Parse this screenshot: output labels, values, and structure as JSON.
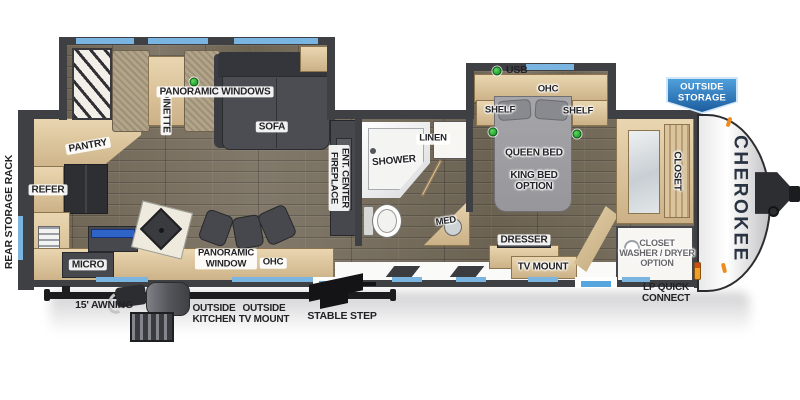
{
  "brand": {
    "name": "CHEROKEE"
  },
  "legend": {
    "usb": "USB"
  },
  "badges": {
    "outside_storage": "OUTSIDE\nSTORAGE"
  },
  "exterior": {
    "rear_storage_rack": "REAR STORAGE RACK",
    "awning": "15' AWNING",
    "outside_kitchen": "OUTSIDE\nKITCHEN",
    "outside_tv_mount": "OUTSIDE\nTV MOUNT",
    "stable_step": "STABLE STEP",
    "lp_quick_connect": "LP QUICK\nCONNECT"
  },
  "rooms": {
    "kitchen": {
      "pantry": "PANTRY",
      "refer": "REFER",
      "micro": "MICRO",
      "panoramic_window": "PANORAMIC\nWINDOW",
      "ohc": "OHC"
    },
    "living": {
      "dinette": "DINETTE",
      "panoramic_windows": "PANORAMIC WINDOWS",
      "sofa": "SOFA",
      "ent_center_fireplace": "ENT. CENTER\nFIREPLACE"
    },
    "bath": {
      "shower": "SHOWER",
      "linen": "LINEN",
      "med": "MED"
    },
    "bedroom": {
      "ohc": "OHC",
      "shelf_left": "SHELF",
      "shelf_right": "SHELF",
      "queen_bed": "QUEEN BED",
      "king_bed_option": "KING BED\nOPTION",
      "dresser": "DRESSER",
      "tv_mount": "TV MOUNT",
      "closet": "CLOSET",
      "washer_dryer_option": "CLOSET\nWASHER / DRYER\nOPTION"
    }
  },
  "colors": {
    "window_blue": "#7ab5e2",
    "wall_gray": "#3f4043",
    "wood_floor": "#776d5c",
    "cabinet_tan": "#dcc49e",
    "usb_green": "#2fae3a",
    "badge_blue": "#2f7fc1",
    "brand_navy": "#2a3342"
  }
}
